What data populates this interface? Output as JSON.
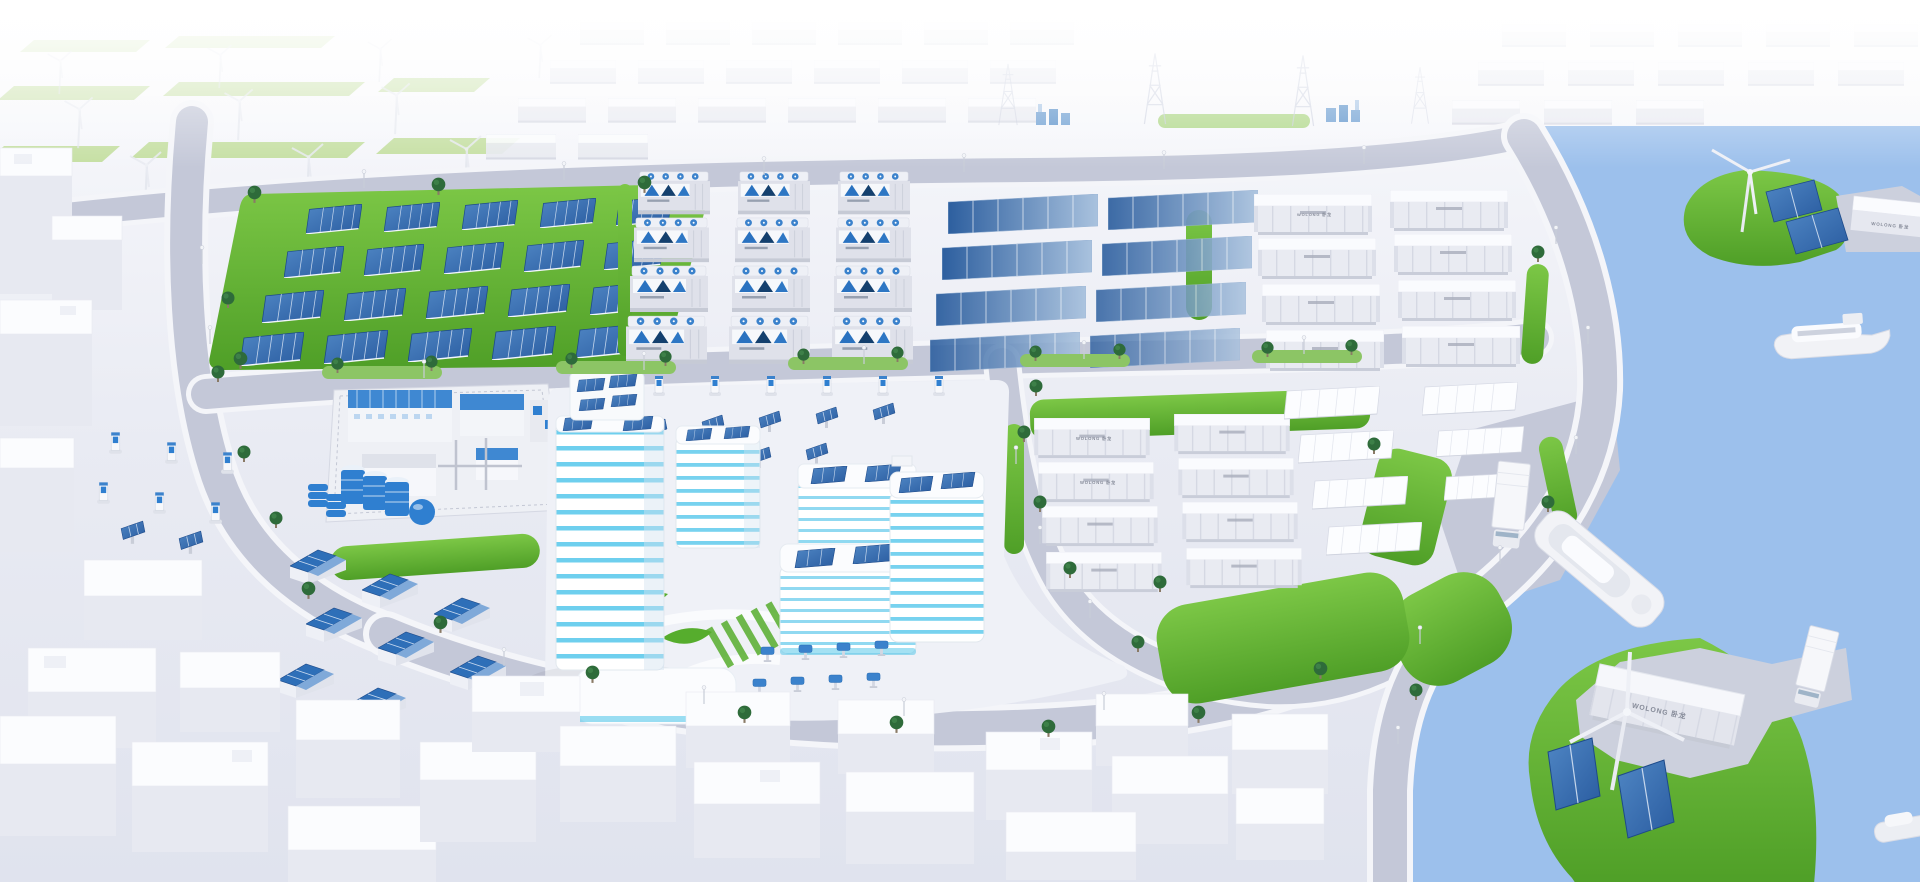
{
  "scene": {
    "labels": {
      "container_brand": "WOLONG 卧龙"
    },
    "colors": {
      "water_light": "#b9d4f4",
      "water": "#9cc0ec",
      "grass_light": "#7cc746",
      "grass": "#4f9f27",
      "grass_strip": "#b7d98d",
      "panel": "#2a5ca0",
      "panel_light": "#4f86c4",
      "panel_dark": "#1d4a8a",
      "aqua": "#4cc5ea",
      "equip_blue": "#2f7fd0",
      "road": "#c4c8d8",
      "sidewalk": "#f4f5f9",
      "building_front": "#e7e9f1",
      "building_side": "#d6d9e4",
      "white": "#fbfcfe",
      "tree": "#2e6b3a"
    }
  }
}
